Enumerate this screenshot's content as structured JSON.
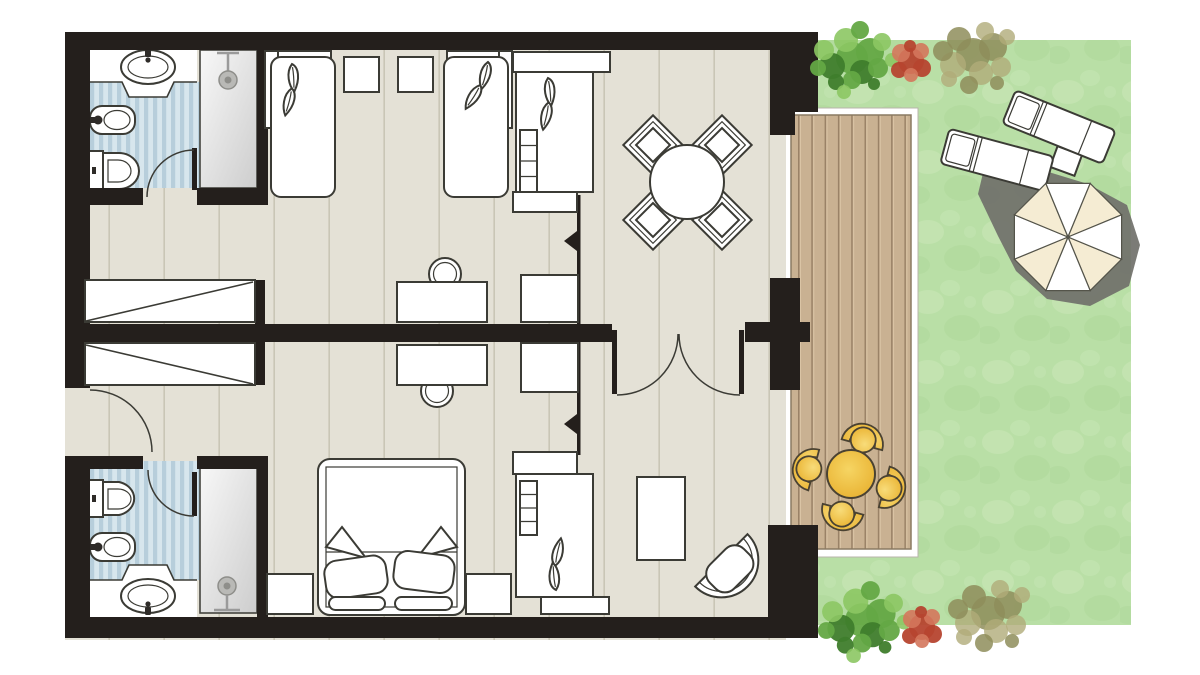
{
  "meta": {
    "kind": "hotel-suite-floor-plan",
    "width_px": 1200,
    "height_px": 675,
    "text_labels": []
  },
  "colors": {
    "wall": "#241f1c",
    "floor": "#e4e1d6",
    "floor_joint": "#c9c6b6",
    "outline": "#3b3b35",
    "tile_base": "#d7e6ed",
    "tile_stripe": "#b7cedb",
    "metal": "#9a9a9a",
    "deck_frame": "#ffffff",
    "deck_wood": "#c9b192",
    "deck_gap": "#9a8267",
    "deck_light": "#dcc6a7",
    "grass": "#b9dfa6",
    "grass_light": "#cfeabd",
    "grass_dark": "#a8d292",
    "shadow": "#70706a",
    "patio_yellow_light": "#f8dc7a",
    "patio_yellow_deep": "#e9b02c",
    "patio_outline": "#4a4232",
    "umbrella_white": "#ffffff",
    "umbrella_cream": "#f5ecd3",
    "bush_green_dark": "#3f7d2c",
    "bush_green": "#64a844",
    "bush_green_light": "#8cc763",
    "bush_red": "#b6452f",
    "bush_red_light": "#d4775c",
    "bush_olive": "#8e8d5b",
    "bush_olive_light": "#b0ab79"
  },
  "rooms": [
    {
      "name": "bathroom-upper",
      "features": [
        "sink",
        "bidet",
        "toilet",
        "shower",
        "striped-tile-floor",
        "door"
      ]
    },
    {
      "name": "bedroom-upper",
      "features": [
        "single-bed",
        "single-bed",
        "nightstand",
        "nightstand",
        "shelf-bed-unit",
        "desk",
        "desk-chair",
        "side-table"
      ]
    },
    {
      "name": "closet-corridor",
      "features": [
        "wardrobe-closet",
        "wardrobe-closet",
        "entrance-door"
      ]
    },
    {
      "name": "living-dining",
      "features": [
        "round-dining-table",
        "dining-chair",
        "dining-chair",
        "dining-chair",
        "dining-chair",
        "double-door"
      ]
    },
    {
      "name": "bedroom-lower",
      "features": [
        "double-bed",
        "nightstand",
        "nightstand",
        "shelf-bed-unit",
        "desk",
        "desk-chair",
        "side-table",
        "coffee-table",
        "lounge-chair"
      ]
    },
    {
      "name": "bathroom-lower",
      "features": [
        "sink",
        "bidet",
        "toilet",
        "shower",
        "striped-tile-floor",
        "door"
      ]
    },
    {
      "name": "terrace-deck",
      "features": [
        "wood-plank-deck",
        "round-patio-table",
        "patio-chair",
        "patio-chair",
        "patio-chair",
        "patio-chair"
      ]
    },
    {
      "name": "garden",
      "features": [
        "lawn",
        "sun-lounger",
        "sun-lounger",
        "side-table",
        "parasol-umbrella",
        "shadow",
        "bush-green",
        "bush-red",
        "bush-olive",
        "bush-green",
        "bush-red",
        "bush-olive"
      ]
    }
  ],
  "counts": {
    "bathrooms": 2,
    "single_beds": 2,
    "double_beds": 1,
    "shelf_bed_units": 2,
    "wardrobes": 2,
    "desks": 2,
    "dining_chairs": 4,
    "patio_chairs": 4,
    "sun_loungers": 2,
    "parasols": 1
  }
}
